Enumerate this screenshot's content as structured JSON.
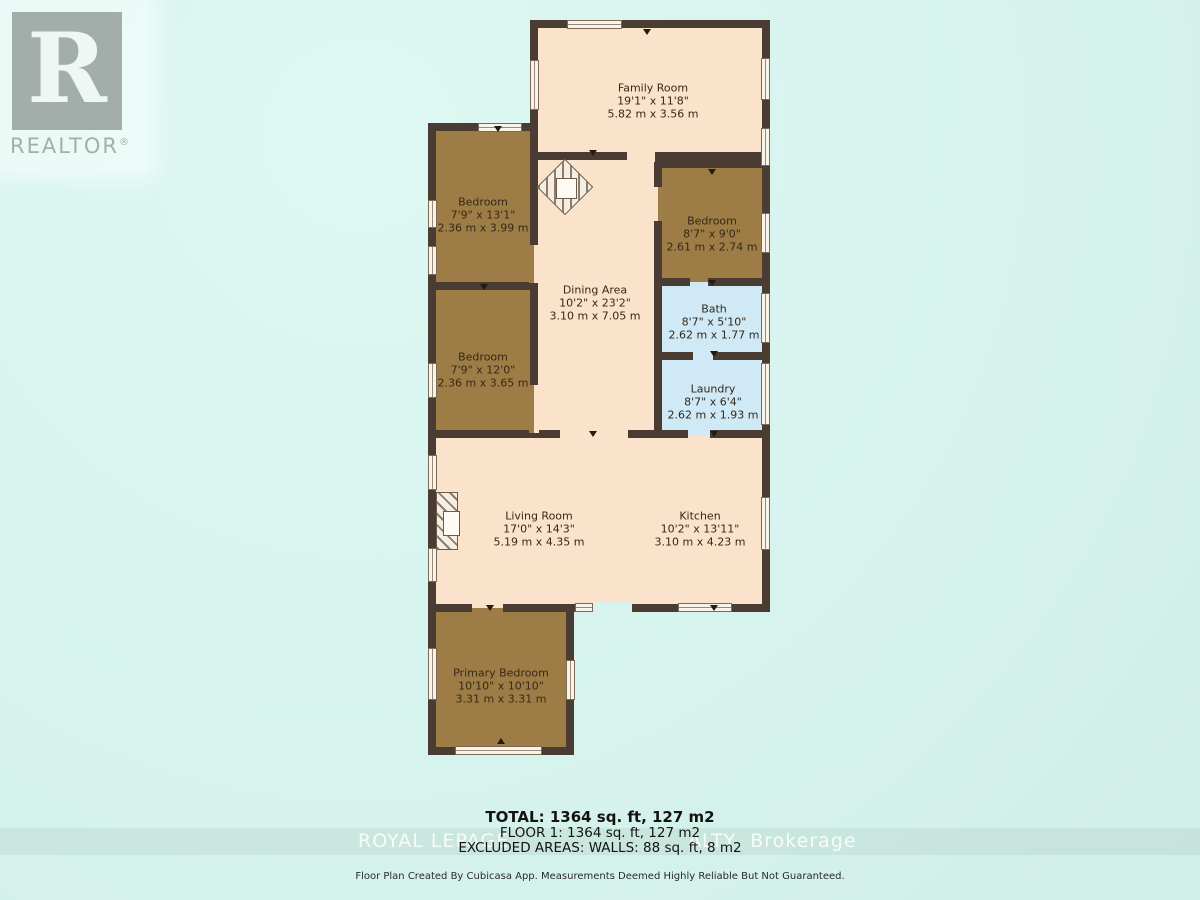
{
  "logo": {
    "brand": "REALTOR",
    "registered": "®",
    "letter": "R"
  },
  "rooms": {
    "family_room": {
      "name": "Family Room",
      "imperial": "19'1\" x 11'8\"",
      "metric": "5.82 m x 3.56 m"
    },
    "bedroom_top_left": {
      "name": "Bedroom",
      "imperial": "7'9\" x 13'1\"",
      "metric": "2.36 m x 3.99 m"
    },
    "bedroom_mid_left": {
      "name": "Bedroom",
      "imperial": "7'9\" x 12'0\"",
      "metric": "2.36 m x 3.65 m"
    },
    "dining_area": {
      "name": "Dining Area",
      "imperial": "10'2\" x 23'2\"",
      "metric": "3.10 m x 7.05 m"
    },
    "bedroom_right": {
      "name": "Bedroom",
      "imperial": "8'7\" x 9'0\"",
      "metric": "2.61 m x 2.74 m"
    },
    "bath": {
      "name": "Bath",
      "imperial": "8'7\" x 5'10\"",
      "metric": "2.62 m x 1.77 m"
    },
    "laundry": {
      "name": "Laundry",
      "imperial": "8'7\" x 6'4\"",
      "metric": "2.62 m x 1.93 m"
    },
    "living_room": {
      "name": "Living Room",
      "imperial": "17'0\" x 14'3\"",
      "metric": "5.19 m x 4.35 m"
    },
    "kitchen": {
      "name": "Kitchen",
      "imperial": "10'2\" x 13'11\"",
      "metric": "3.10 m x 4.23 m"
    },
    "primary_bedroom": {
      "name": "Primary Bedroom",
      "imperial": "10'10\" x 10'10\"",
      "metric": "3.31 m x 3.31 m"
    }
  },
  "summary": {
    "total": "TOTAL: 1364 sq. ft, 127 m2",
    "floor1": "FLOOR 1: 1364 sq. ft, 127 m2",
    "excluded": "EXCLUDED AREAS: WALLS: 88 sq. ft, 8 m2"
  },
  "watermark": {
    "left": "ROYAL LEPAGE",
    "right": "ALTY, Brokerage"
  },
  "disclaimer": "Floor Plan Created By Cubicasa App. Measurements Deemed Highly Reliable But Not Guaranteed.",
  "colors": {
    "background": "#d6f3ed",
    "wall": "#4b3c33",
    "floor_living": "#fbe3cb",
    "floor_bedroom": "#9d7d45",
    "floor_wet_room": "#cfe9f7",
    "logo_gray": "#a3aeaa",
    "watermark_text": "#ffffff"
  }
}
